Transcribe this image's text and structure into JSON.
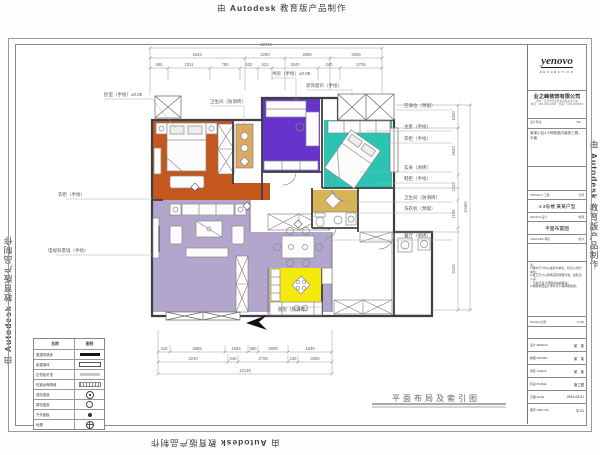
{
  "watermark": {
    "prefix": "由",
    "brand": "Autodesk",
    "suffix": "教育版产品制作"
  },
  "sheet_title": {
    "text": "平面布局及索引图"
  },
  "title_block": {
    "logo": "yenovo",
    "logo_sub": "DECORATION",
    "company": "业之峰装饰有限公司",
    "address1": "地址：某某市某某区某某路某某大厦",
    "address2": "电话：400-0000-0000　传真：0000-0000000",
    "contact_left": "设计专线",
    "contact_right": "TEL：",
    "project_desc": "某某小区4-3号楼室内装饰工程，平面",
    "mid_rows": [
      {
        "label": "PROJECT 工程",
        "value": "名称"
      },
      {
        "label": "DESIGN 设计",
        "value": "制图"
      },
      {
        "label": "CHECKED 审核",
        "value": "校对"
      }
    ],
    "unit_name": "4-3号楼 某某户型",
    "drawing_name": "平面布置图",
    "note_title": "注：",
    "note_lines": [
      "1.图中尺寸均以毫米为单位，标高以米为单位；",
      "2.施工尺寸以现场实际测量为准，如有出入请",
      "　及时与设计师联系协商解决；",
      "3.本图未经设计师许可不得转借他用。"
    ],
    "scale_row": {
      "label": "SCALE 比例",
      "value": "1:100"
    },
    "bottom_rows": [
      {
        "label": "设计 DESIGN",
        "value": "某　某"
      },
      {
        "label": "制图 DRAWN",
        "value": "某　某"
      },
      {
        "label": "审核 CHECK",
        "value": "某　某"
      },
      {
        "label": "阶段 PHASE",
        "value": "施工图"
      },
      {
        "label": "日期 DATE",
        "value": "2014.03.01"
      },
      {
        "label": "图号 DWG NO.",
        "value": "平-01"
      }
    ]
  },
  "legend": {
    "headers": [
      "名称",
      "图例"
    ],
    "rows": [
      {
        "label": "原建筑墙体",
        "symbol": "solid-wall"
      },
      {
        "label": "新建墙体",
        "symbol": "new-wall"
      },
      {
        "label": "石膏板吊顶",
        "symbol": "gypsum"
      },
      {
        "label": "轻钢龙骨隔墙",
        "symbol": "stud-wall"
      },
      {
        "label": "强电插座",
        "symbol": "power-outlet"
      },
      {
        "label": "弱电插座",
        "symbol": "low-voltage"
      },
      {
        "label": "开关面板",
        "symbol": "switch"
      },
      {
        "label": "地漏",
        "symbol": "floor-drain"
      }
    ]
  },
  "dimensions": {
    "top_total": "12740",
    "top_row2": [
      "4633",
      "2280",
      "2895",
      "2805"
    ],
    "top_row3": [
      "860",
      "2311",
      "780",
      "620",
      "523",
      "3040",
      "240",
      "2705"
    ],
    "bottom_row1": [
      "419",
      "3865",
      "1565",
      "580",
      "2805",
      "1835"
    ],
    "bottom_row2": [
      "4240",
      "240",
      "2705",
      "240",
      "3350"
    ],
    "bottom_total": "10135",
    "right_values": [
      "1050",
      "4533",
      "1243",
      "1195",
      "2445"
    ],
    "right_total": "10460"
  },
  "annotations": {
    "bedroom": "卧室（手绘）±0.00",
    "bath_top": "卫生间（防滑砖）",
    "study": "书房（手绘）±0.00",
    "curtain": "装饰窗帘（手绘）",
    "ac": "空调位（预留）",
    "master": "主卧（手绘）",
    "wardrobe": "衣柜（手绘）",
    "entry": "玄关（地砖）",
    "shoe": "鞋柜（手绘）",
    "bath": "卫生间（防滑砖）",
    "washer": "洗衣机（预留）",
    "dining": "餐厅（地砖）",
    "closet_left": "衣柜（手绘）",
    "tv_wall": "电视背景墙（手绘）",
    "kitchen": "厨房（防滑砖）"
  },
  "colors": {
    "bedroom2": "#c4571e",
    "study": "#6633cc",
    "master": "#29c5b2",
    "bathroom": "#d7b557",
    "kitchen": "#f4e90c",
    "living": "#b3a6cd"
  }
}
